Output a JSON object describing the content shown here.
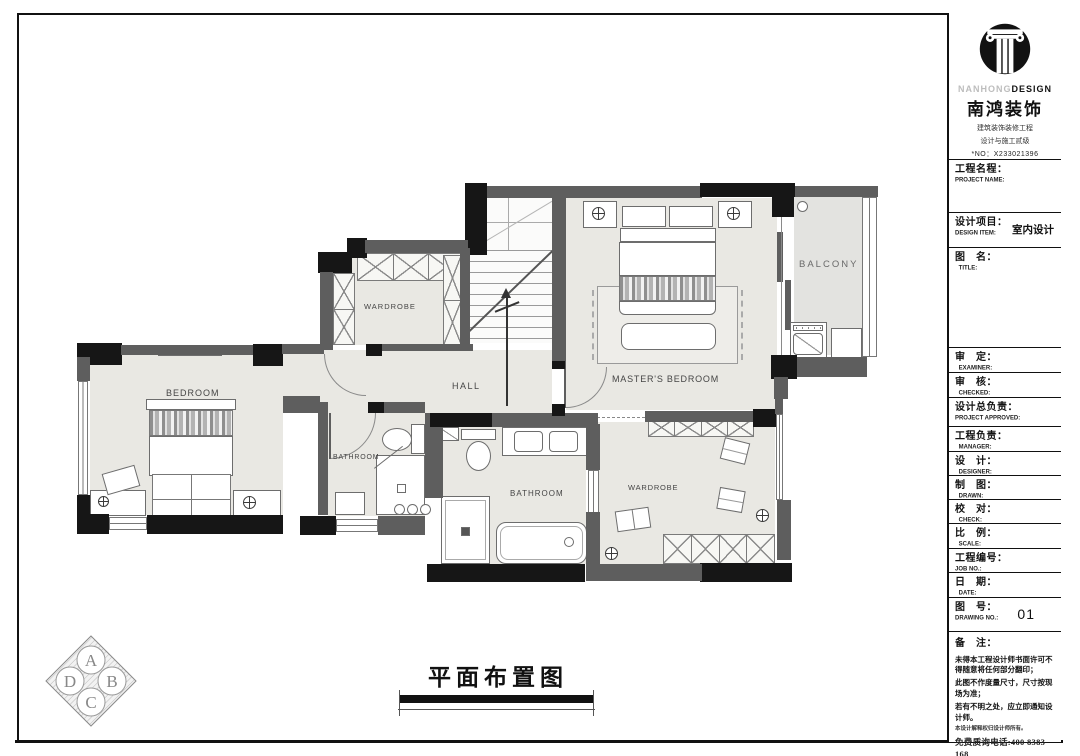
{
  "title_block": {
    "brand": {
      "en_light": "NANHONG",
      "en_bold": "DESIGN",
      "cn": "南鸿装饰",
      "sub1": "建筑装饰装修工程",
      "sub2": "设计与施工贰级",
      "license": "*NO：X233021396"
    },
    "fields": [
      {
        "cn": "工程名程：",
        "en": "PROJECT NAME:",
        "value": ""
      },
      {
        "cn": "设计项目：",
        "en": "DESIGN ITEM:",
        "value": "室内设计"
      },
      {
        "cn": "图　名：",
        "en": "TITLE:",
        "value": ""
      },
      {
        "cn": "审　定：",
        "en": "EXAMINER:",
        "value": ""
      },
      {
        "cn": "审　核：",
        "en": "CHECKED:",
        "value": ""
      },
      {
        "cn": "设计总负责：",
        "en": "PROJECT APPROVED:",
        "value": ""
      },
      {
        "cn": "工程负责：",
        "en": "MANAGER:",
        "value": ""
      },
      {
        "cn": "设　计：",
        "en": "DESIGNER:",
        "value": ""
      },
      {
        "cn": "制　图：",
        "en": "DRAWN:",
        "value": ""
      },
      {
        "cn": "校　对：",
        "en": "CHECK:",
        "value": ""
      },
      {
        "cn": "比　例：",
        "en": "SCALE:",
        "value": ""
      },
      {
        "cn": "工程编号：",
        "en": "JOB  NO.:",
        "value": ""
      },
      {
        "cn": "日　期：",
        "en": "DATE:",
        "value": ""
      },
      {
        "cn": "图　号：",
        "en": "DRAWING NO.:",
        "value": "01"
      }
    ],
    "remarks": {
      "label": "备　注：",
      "lines": [
        "未得本工程设计师书面许可不得随意将任何部分翻印；",
        "此图不作度量尺寸，尺寸按现场为准；",
        "若有不明之处，应立即通知设计师。"
      ],
      "fine_print": "本设计解释权归设计师所有。",
      "hotline": "免费质询电话:400 8383 168"
    }
  },
  "plan": {
    "drawing_title": "平面布置图",
    "rooms": [
      {
        "label": "BEDROOM"
      },
      {
        "label": "WARDROBE"
      },
      {
        "label": "HALL"
      },
      {
        "label": "MASTER'S BEDROOM"
      },
      {
        "label": "BALCONY"
      },
      {
        "label": "BATHROOM"
      },
      {
        "label": "BATHROOM"
      },
      {
        "label": "WARDROBE"
      }
    ]
  },
  "compass": {
    "top": "A",
    "right": "B",
    "bottom": "C",
    "left": "D"
  },
  "colors": {
    "wall_gray": "#5e5e5e",
    "wall_black": "#161616",
    "floor": "#e9e8e3"
  }
}
